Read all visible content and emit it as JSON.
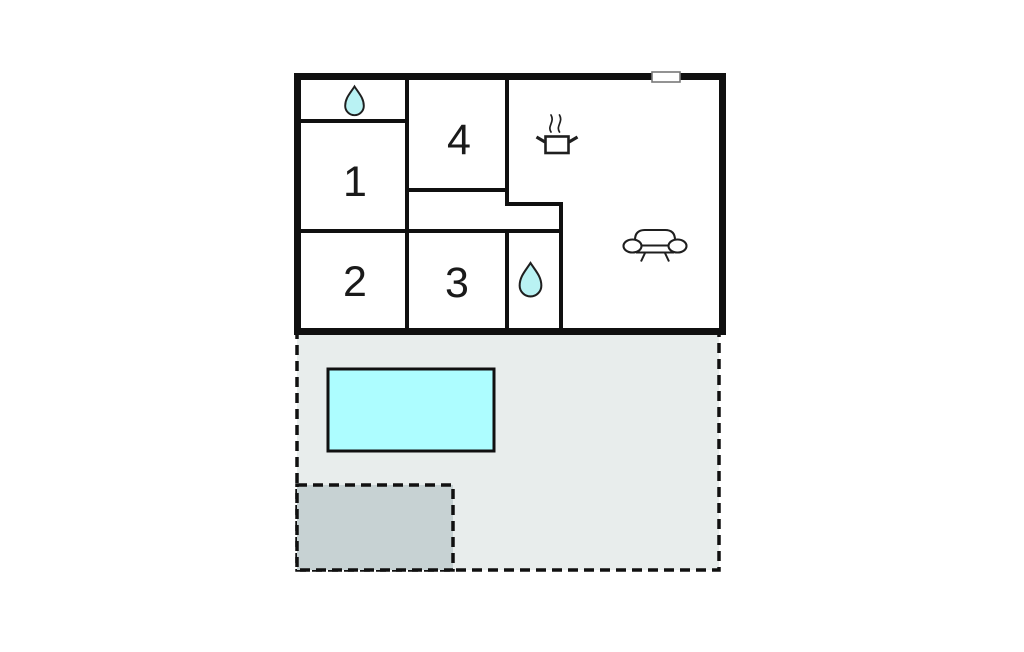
{
  "rooms": [
    {
      "id": "room-1",
      "number": "1"
    },
    {
      "id": "room-2",
      "number": "2"
    },
    {
      "id": "room-3",
      "number": "3"
    },
    {
      "id": "room-4",
      "number": "4"
    }
  ],
  "icons": {
    "bathroom_top": "water-drop-icon",
    "bathroom_middle": "water-drop-icon",
    "kitchen": "cooking-pot-icon",
    "living_room": "sofa-icon",
    "top_wall": "window-icon"
  },
  "colors": {
    "background": "#ffffff",
    "wall": "#101010",
    "room_fill": "#ffffff",
    "terrace_fill": "#e8edec",
    "pool_fill": "#adfdff",
    "patio_fill": "#c7d2d3",
    "drop_fill": "#b9f2f3",
    "window_fill": "#ffffff",
    "window_border": "#787878",
    "icon_stroke": "#1f1f1f",
    "label_color": "#1a1a1a"
  }
}
